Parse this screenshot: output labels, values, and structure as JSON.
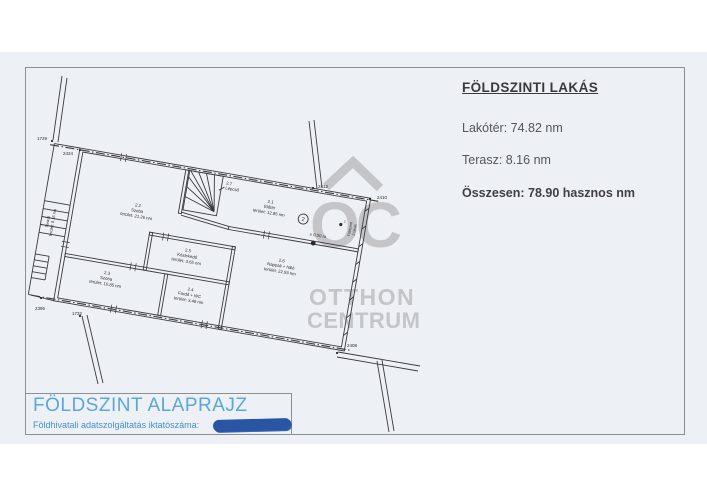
{
  "info_panel": {
    "title": "FÖLDSZINTI LAKÁS",
    "line1": "Lakótér: 74.82 nm",
    "line2": "Terasz: 8.16 nm",
    "total": "Összesen: 78.90 hasznos nm"
  },
  "title_block": {
    "title": "FÖLDSZINT ALAPRAJZ",
    "subtitle": "Földhivatali adatszolgáltatás iktatószáma:"
  },
  "watermark": {
    "monogram": "OC",
    "brand_top": "OTTHON",
    "brand_bottom": "CENTRUM"
  },
  "plan": {
    "rooms": [
      {
        "id": "2.1",
        "name": "Előtér",
        "area": "terület: 12.85 nm"
      },
      {
        "id": "2.2",
        "name": "Szoba",
        "area": "terület: 21.26 nm"
      },
      {
        "id": "2.3",
        "name": "Szoba",
        "area": "terület: 10.85 nm"
      },
      {
        "id": "2.4",
        "name": "Fürdő + WC",
        "area": "terület: 3.48 nm"
      },
      {
        "id": "2.5",
        "name": "Közlekedő",
        "area": "terület: 3.65 nm"
      },
      {
        "id": "2.6",
        "name": "Nappali + háló",
        "area": "terület: 22.93 nm"
      }
    ],
    "stair": {
      "id": "2.7",
      "name": "Lépcső"
    },
    "terasz": {
      "name": "Terasz",
      "area": "terület: 8.16 nm"
    },
    "level_marker": "± 0.00 m",
    "unit_circle": "2",
    "point_label": "2",
    "wall_text_1": "Földszint",
    "wall_text_2": "2 lakás",
    "dimensions": [
      "1729",
      "2424",
      "2412",
      "2410",
      "2408",
      "2395",
      "1732"
    ],
    "colors": {
      "line": "#3a3a40",
      "accent_blue": "#5aa7d8",
      "redaction_blue": "#2a55a4",
      "watermark_gray": "#c4c5c9"
    }
  }
}
